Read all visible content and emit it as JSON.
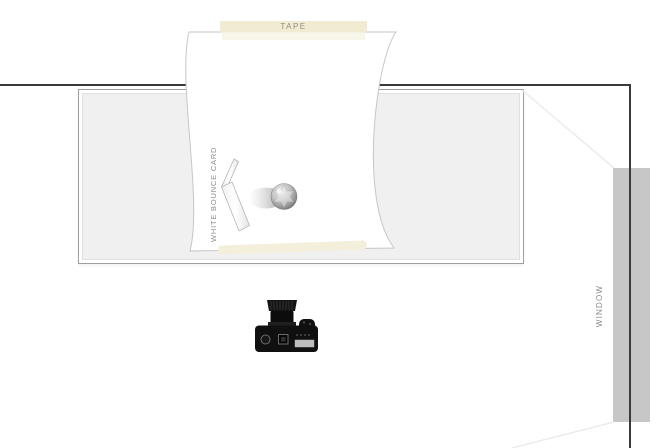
{
  "scene": {
    "description": "Top-down photography lighting setup diagram",
    "labels": {
      "tape": "TAPE",
      "bounce_card": "WHITE BOUNCE CARD",
      "window": "WINDOW"
    },
    "objects": [
      "back wall",
      "table",
      "curled paper sweep backdrop",
      "tape strip top",
      "tape strip bottom",
      "white bounce card",
      "spherical subject with cast shadow",
      "dslr camera top view",
      "window",
      "window light rays"
    ],
    "colors": {
      "wall": "#3a3a3a",
      "table_fill": "#f0f0f0",
      "paper": "#ffffff",
      "paper_edge": "#c6c6c6",
      "tape": "#f1ecd1",
      "window": "#c7c7c7",
      "label_text": "#8a8a88",
      "camera_body": "#101010"
    }
  }
}
